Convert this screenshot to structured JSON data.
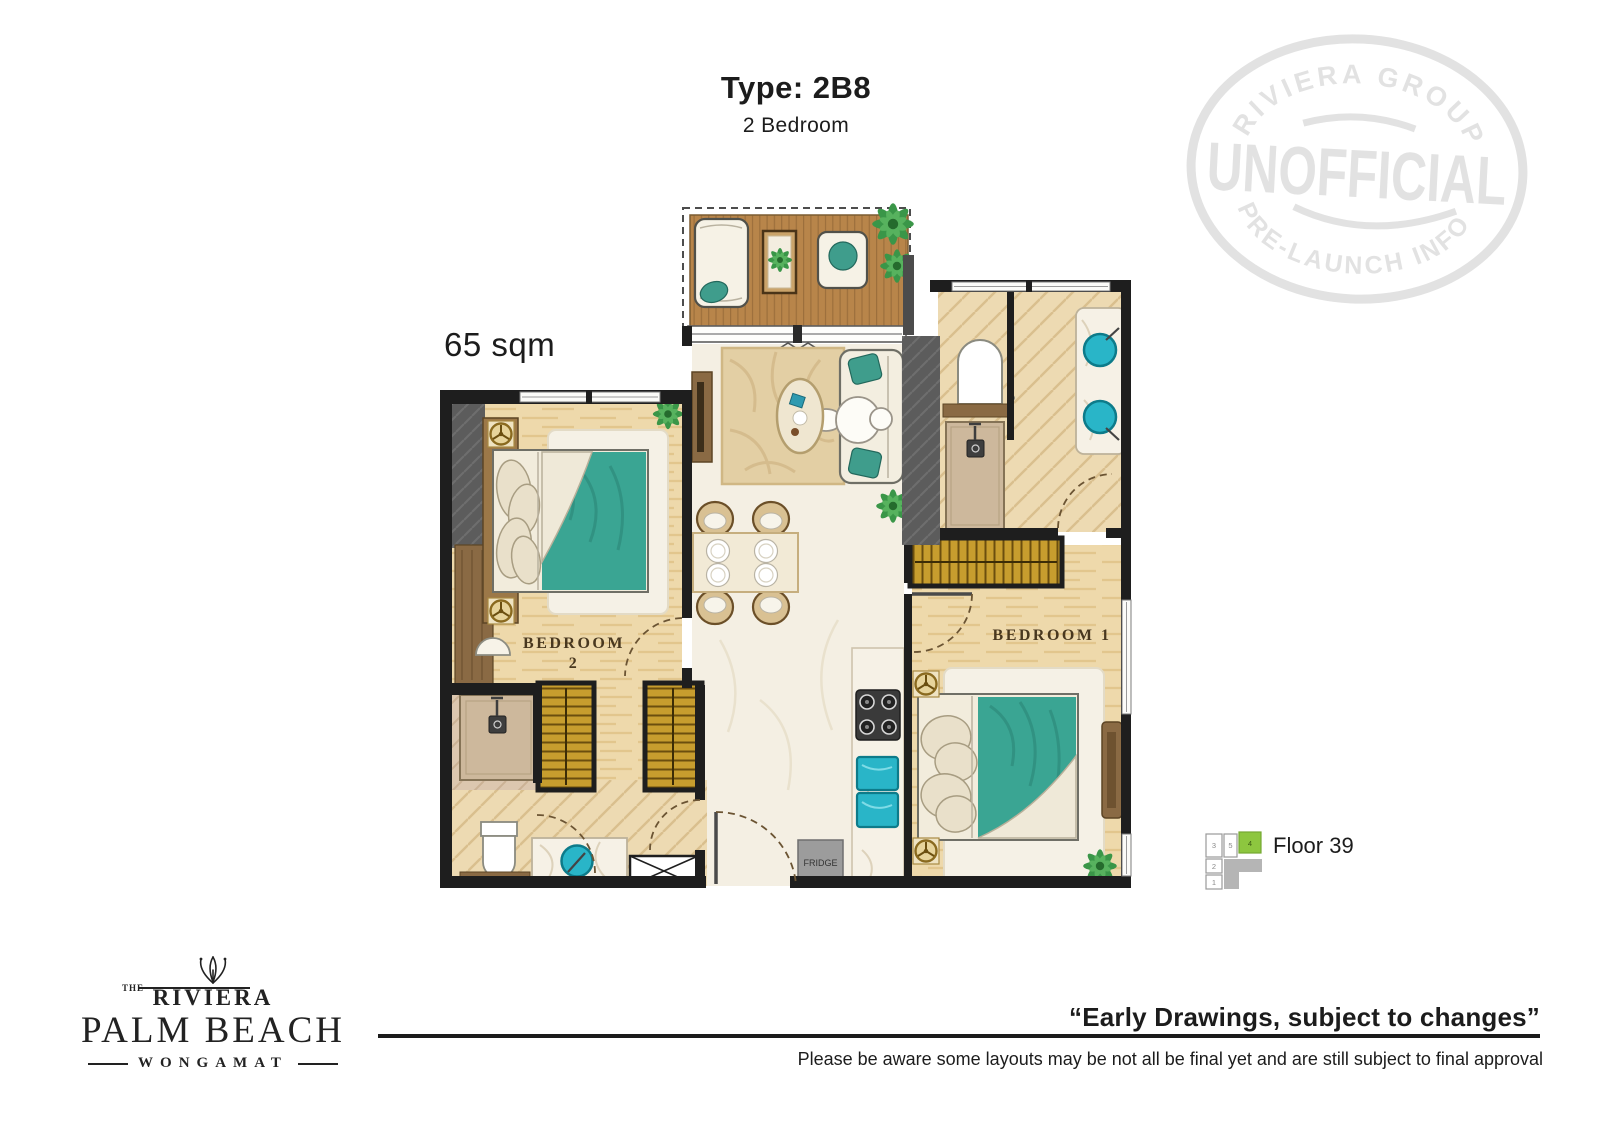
{
  "header": {
    "title": "Type: 2B8",
    "subtitle": "2 Bedroom"
  },
  "plan": {
    "area_label": "65 sqm",
    "bedroom1_label": "BEDROOM 1",
    "bedroom2_label_line1": "BEDROOM",
    "bedroom2_label_line2": "2",
    "fridge_label": "FRIDGE"
  },
  "stamp": {
    "arc_top": "RIVIERA GROUP",
    "center": "UNOFFICIAL",
    "arc_bottom": "PRE-LAUNCH INFO",
    "color": "#e2e2e2"
  },
  "floor_indicator": {
    "label": "Floor 39",
    "highlight_color": "#8dc63f",
    "cells": {
      "c1": "1",
      "c2": "2",
      "c3": "3",
      "c4": "4",
      "c5": "5"
    }
  },
  "logo": {
    "the": "THE",
    "brand": "RIVIERA",
    "line2": "PALM BEACH",
    "line3": "WONGAMAT"
  },
  "footer": {
    "quote": "“Early Drawings, subject to changes”",
    "disclaimer": "Please be aware some layouts may be not all be final yet and are still subject to final approval"
  },
  "colors": {
    "wall": "#1e1e1e",
    "accent_gray": "#5c5c5c",
    "deck_wood": "#b8854a",
    "floor_wood": "#eed9ab",
    "marble": "#f4efe3",
    "teal": "#3aa593",
    "cyan": "#29b5c8",
    "gold": "#c79d2e",
    "stamp_gray": "#e2e2e2",
    "floor_highlight": "#8dc63f"
  }
}
